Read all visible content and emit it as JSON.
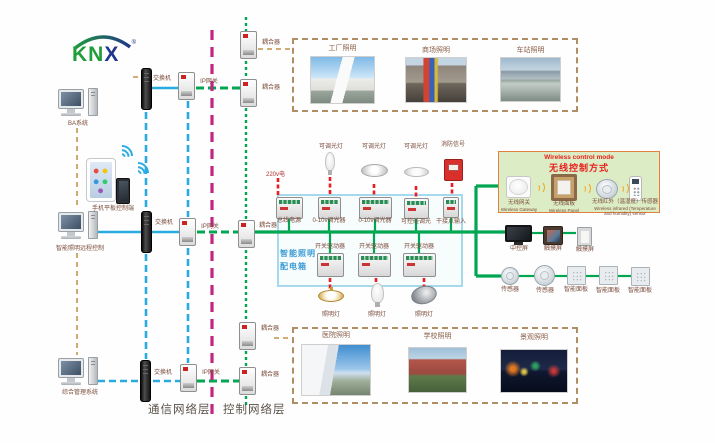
{
  "logo": {
    "text_green": "KN",
    "text_blue": "X",
    "reg": "®"
  },
  "computers": {
    "ba": "BA系统",
    "mobile": "手机平板控制端",
    "remote": "智能照明远程控制",
    "management": "综合管理系统"
  },
  "network": {
    "switch": "交换机",
    "gateway": "IP网关",
    "coupler": "耦合器"
  },
  "layers": {
    "communication": "通信网络层",
    "control": "控制网络层"
  },
  "photos_top": [
    {
      "label": "工厂照明"
    },
    {
      "label": "商场照明"
    },
    {
      "label": "车站照明"
    }
  ],
  "photos_bottom": [
    {
      "label": "医院照明"
    },
    {
      "label": "学校照明"
    },
    {
      "label": "景观照明"
    }
  ],
  "panel": {
    "name_line1": "智能照明",
    "name_line2": "配电箱",
    "power": "220v电",
    "loads_top": [
      {
        "label": "可调光灯"
      },
      {
        "label": "可调光灯"
      },
      {
        "label": "可调光灯"
      },
      {
        "label": "消防信号"
      }
    ],
    "devices_row1": [
      {
        "label": "总线电源"
      },
      {
        "label": "0-10v调光器"
      },
      {
        "label": "0-10v调光器"
      },
      {
        "label": "可控硅调光"
      },
      {
        "label": "干接点输入"
      }
    ],
    "devices_row2": [
      {
        "label": "开关驱动器"
      },
      {
        "label": "开关驱动器"
      },
      {
        "label": "开关驱动器"
      }
    ],
    "lamps": [
      {
        "label": "照明灯"
      },
      {
        "label": "照明灯"
      },
      {
        "label": "照明灯"
      }
    ]
  },
  "wireless": {
    "title_en": "Wireless control mode",
    "title_zh": "无线控制方式",
    "gateway_zh": "无线网关",
    "gateway_en": "Wireless Gateway",
    "panel_zh": "无线面板",
    "panel_en": "Wireless Panel",
    "sensor_zh": "无线红外（温湿度）传感器",
    "sensor_en": "Wireless infrared (Temperature and humidity) sensor"
  },
  "right_devices": {
    "central_screen": "中控屏",
    "touch_screen_1": "触摸屏",
    "touch_screen_2": "触摸屏",
    "sensor_1": "传感器",
    "sensor_2": "传感器",
    "smart_panel_1": "智能面板",
    "smart_panel_2": "智能面板",
    "smart_panel_3": "智能面板"
  },
  "colors": {
    "bus_green": "#00A651",
    "ethernet_blue": "#29ABE2",
    "backbone_magenta": "#C2267F",
    "management_tan": "#C9A063",
    "power_red": "#ED1C24",
    "label_brown": "#7A4B3A",
    "panel_label_blue": "#3A9BD5",
    "wireless_title_red": "#E8201E",
    "wireless_bg": "#DCECC5",
    "wireless_border": "#E0813F"
  }
}
